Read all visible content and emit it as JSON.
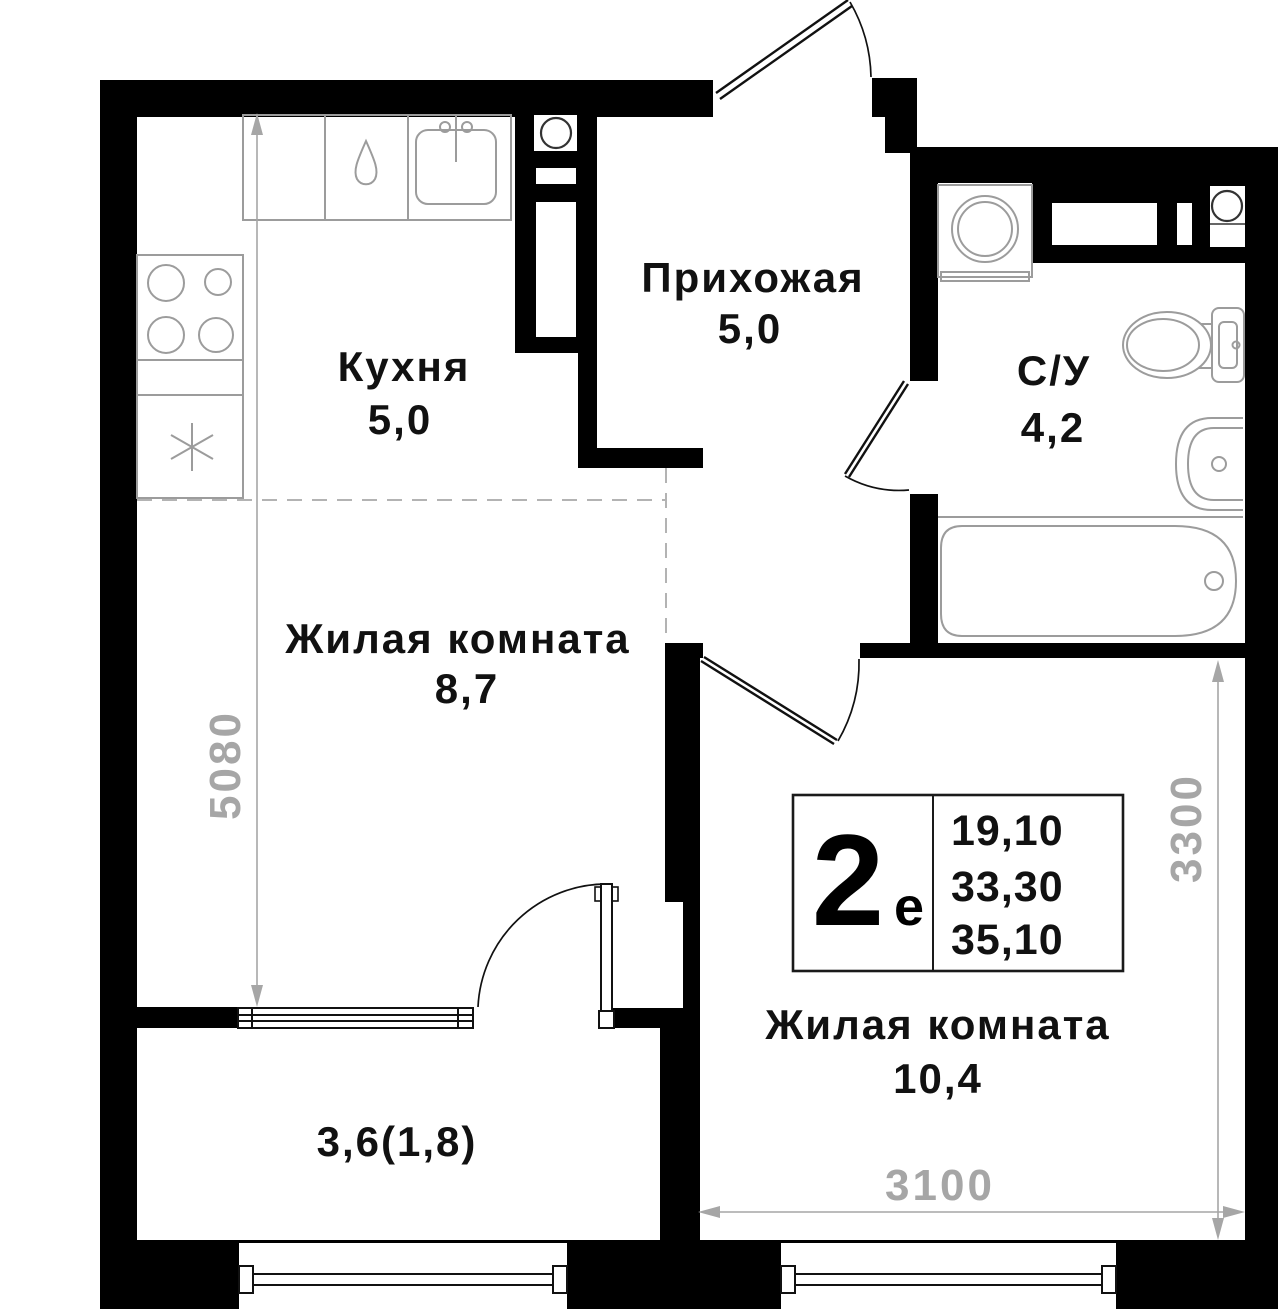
{
  "plan": {
    "rooms": {
      "kitchen": {
        "name": "Кухня",
        "area": "5,0"
      },
      "hallway": {
        "name": "Прихожая",
        "area": "5,0"
      },
      "bathroom": {
        "name": "С/У",
        "area": "4,2"
      },
      "living_main": {
        "name": "Жилая комната",
        "area": "8,7"
      },
      "living_second": {
        "name": "Жилая комната",
        "area": "10,4"
      },
      "balcony": {
        "area": "3,6(1,8)"
      }
    },
    "unit_card": {
      "rooms_count": "2",
      "rooms_suffix": "е",
      "area_living": "19,10",
      "area_main": "33,30",
      "area_total": "35,10"
    },
    "dimensions": {
      "left_height": "5080",
      "right_height": "3300",
      "bottom_width": "3100"
    },
    "colors": {
      "wall": "#000000",
      "background": "#ffffff",
      "fixture_outline": "#9c9c9c",
      "dimension_gray": "#a6a6a6",
      "label_text": "#111111"
    }
  }
}
